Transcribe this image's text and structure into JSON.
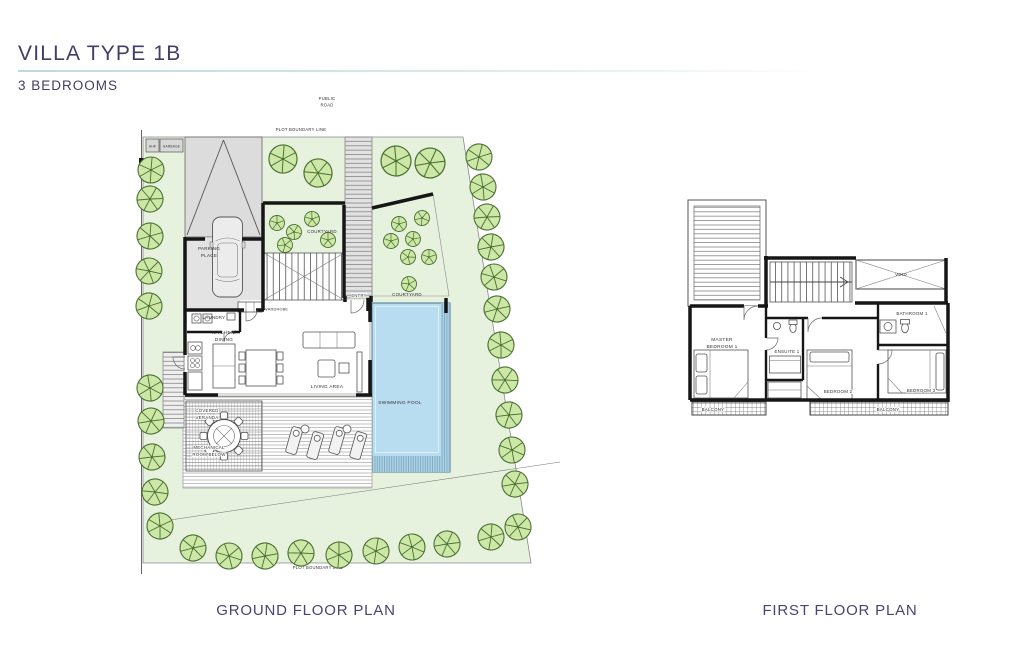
{
  "header": {
    "title": "VILLA TYPE 1B",
    "subtitle": "3 BEDROOMS"
  },
  "ground_floor": {
    "caption": "GROUND FLOOR PLAN",
    "site": {
      "public_road_line1": "PUBLIC",
      "public_road_line2": "ROAD",
      "plot_boundary_top": "PLOT BOUNDARY LINE",
      "plot_boundary_bottom": "PLOT BOUNDARY LINE"
    },
    "rooms": {
      "ahk": "AHK",
      "garbage": "GARBAGE",
      "parking_line1": "PARKING",
      "parking_line2": "PLACE",
      "courtyard_upper": "COURTYARD",
      "courtyard_entry": "COURTYARD",
      "entry": "ENTRY",
      "wardrobe": "WARDROBE",
      "laundry": "LAUNDRY",
      "kitchen_line1": "KITCHEN/",
      "kitchen_line2": "DINING",
      "living_area": "LIVING AREA",
      "swimming_pool": "SWIMMING POOL",
      "veranda_line1": "COVERED",
      "veranda_line2": "VERANDA",
      "mechanical_line1": "MECHANICAL",
      "mechanical_line2": "ROOM BELOW"
    }
  },
  "first_floor": {
    "caption": "FIRST FLOOR PLAN",
    "rooms": {
      "void": "VOID",
      "master_line1": "MASTER",
      "master_line2": "BEDROOM 1",
      "ensuite": "ENSUITE 1",
      "bathroom": "BATHROOM 1",
      "bedroom2": "BEDROOM 2",
      "bedroom3": "BEDROOM 3",
      "balcony_left": "BALCONY",
      "balcony_right": "BALCONY"
    }
  },
  "colors": {
    "title-purple": "#433e66",
    "underline-teal": "#bcdad8",
    "plot-green": "#e7f2de",
    "tree-fill": "#cde7a7",
    "tree-stroke": "#4a7033",
    "pool-blue": "#b9ddf0",
    "wall-black": "#161616",
    "line-gray": "#555555"
  }
}
